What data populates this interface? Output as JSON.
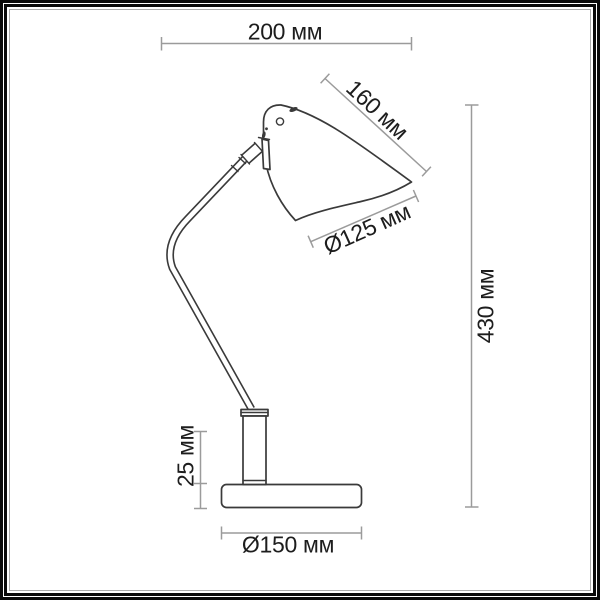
{
  "drawing": {
    "object": "desk-lamp-technical-drawing",
    "dimensions": {
      "width": {
        "label": "200 мм"
      },
      "shade_length": {
        "label": "160 мм"
      },
      "shade_diameter": {
        "label": "Ø125 мм"
      },
      "height": {
        "label": "430 мм"
      },
      "base_height": {
        "label": "25 мм"
      },
      "base_diameter": {
        "label": "Ø150 мм"
      }
    },
    "colors": {
      "ink": "#1d1d1d",
      "line": "#3a3a3a",
      "dim_line": "#9b9b9b",
      "frame": "#0a0a0a",
      "background": "#ffffff"
    }
  }
}
